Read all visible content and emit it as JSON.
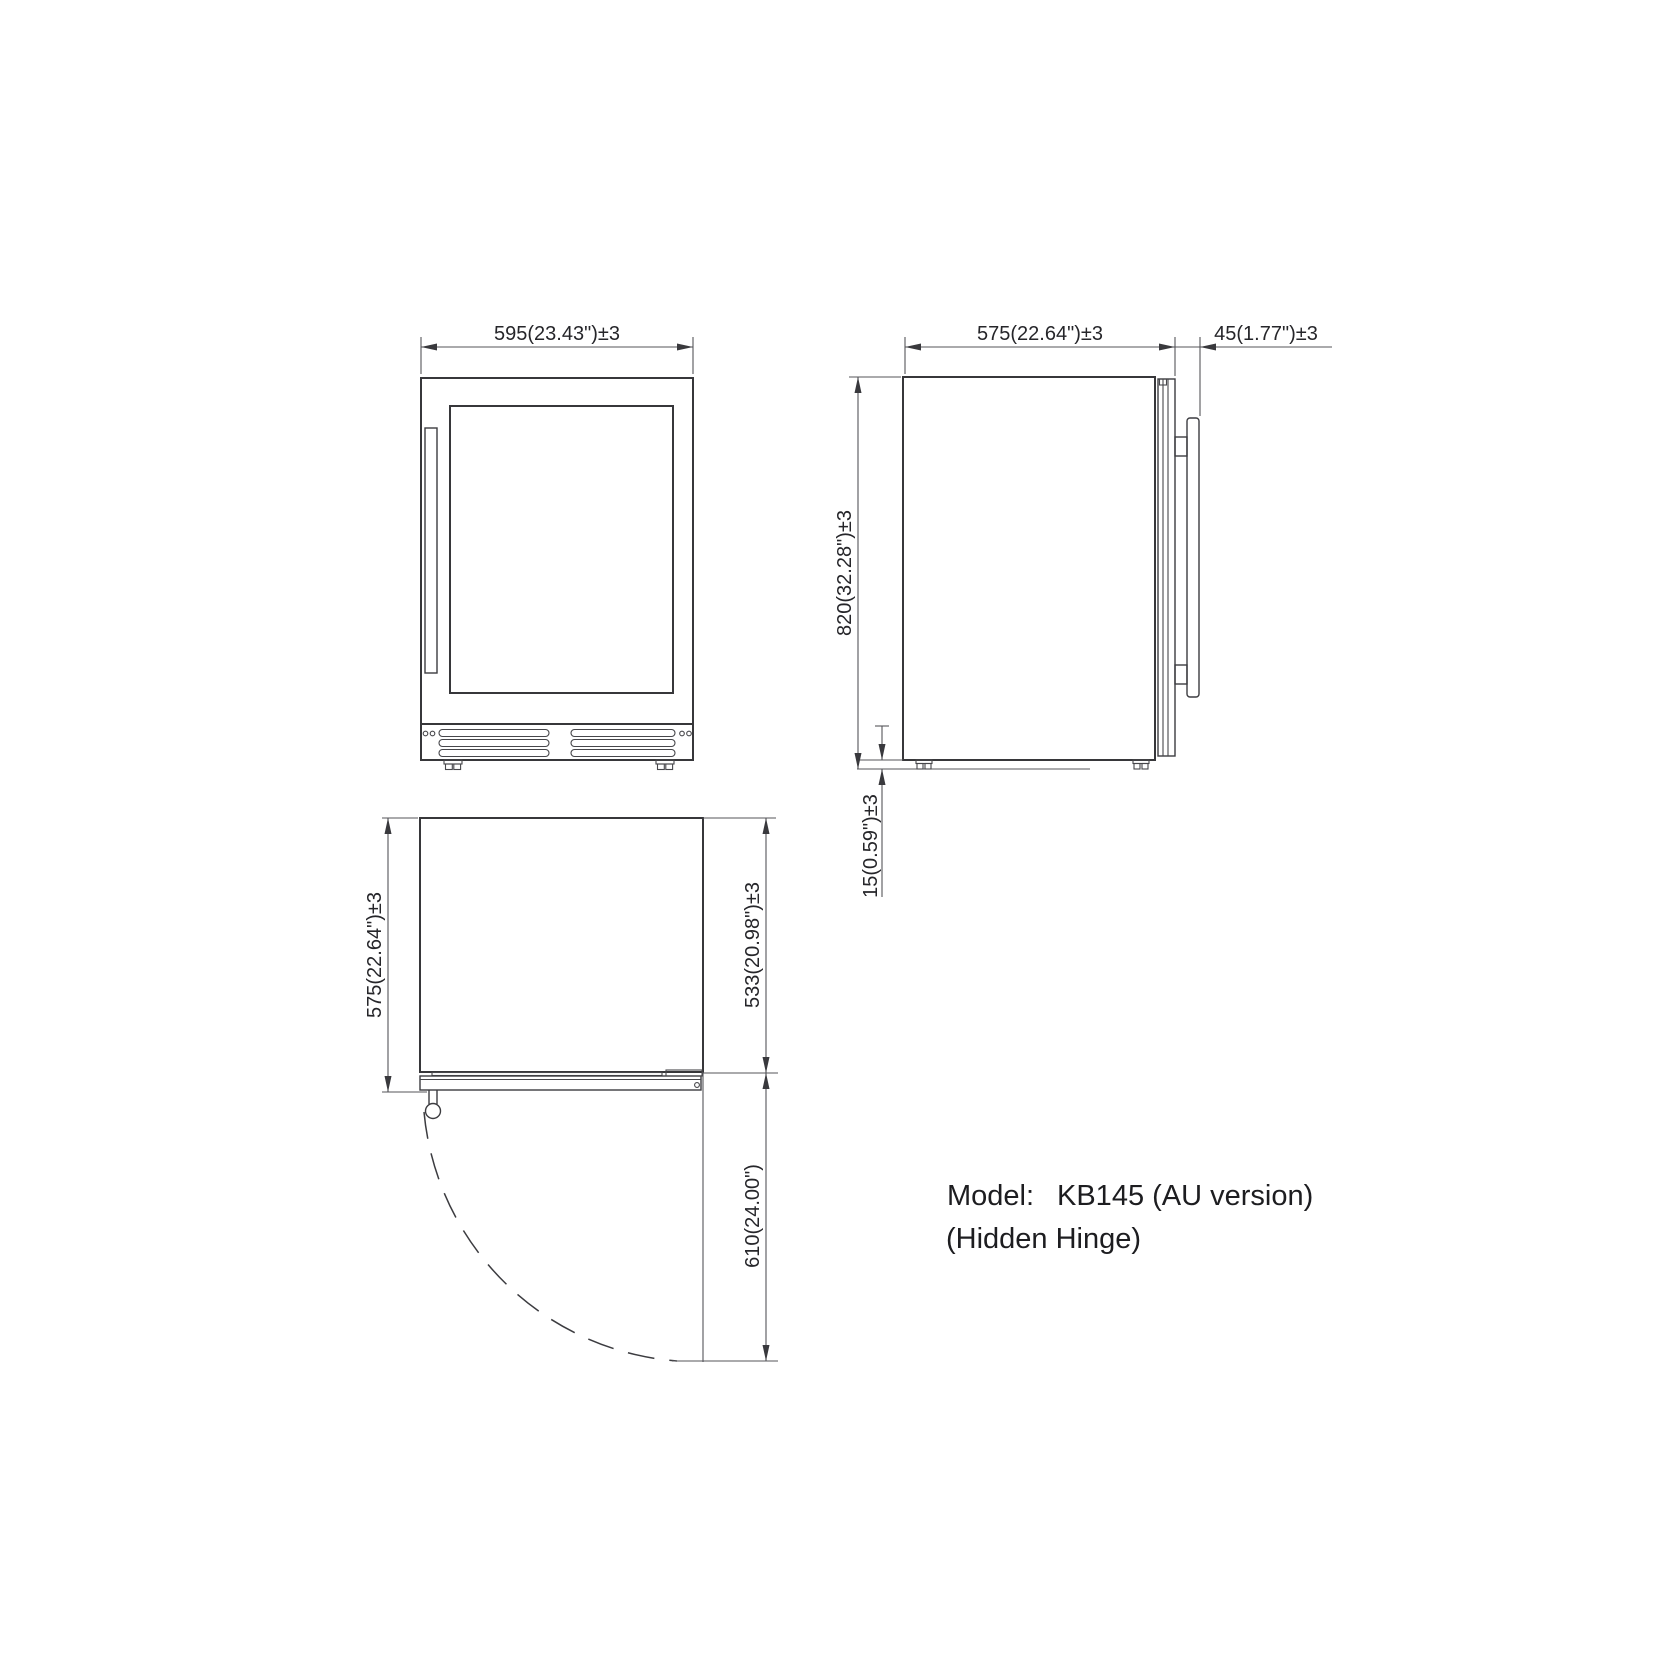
{
  "views": {
    "front": {
      "name": "front view",
      "width_dim": "595(23.43\")±3"
    },
    "side": {
      "name": "side view",
      "depth_dim": "575(22.64\")±3",
      "handle_dim": "45(1.77\")±3",
      "height_dim": "820(32.28\")±3",
      "leg_dim": "15(0.59\")±3"
    },
    "top": {
      "name": "top view",
      "depth_dim": "575(22.64\")±3",
      "cabinet_depth_dim": "533(20.98\")±3",
      "door_swing_dim": "610(24.00\")"
    }
  },
  "model": {
    "label": "Model:",
    "value": "KB145 (AU version)",
    "note": "(Hidden Hinge)"
  },
  "colors": {
    "background": "#ffffff",
    "object_line": "#37373a",
    "dimension_line": "#55555a",
    "text": "#26262a"
  }
}
